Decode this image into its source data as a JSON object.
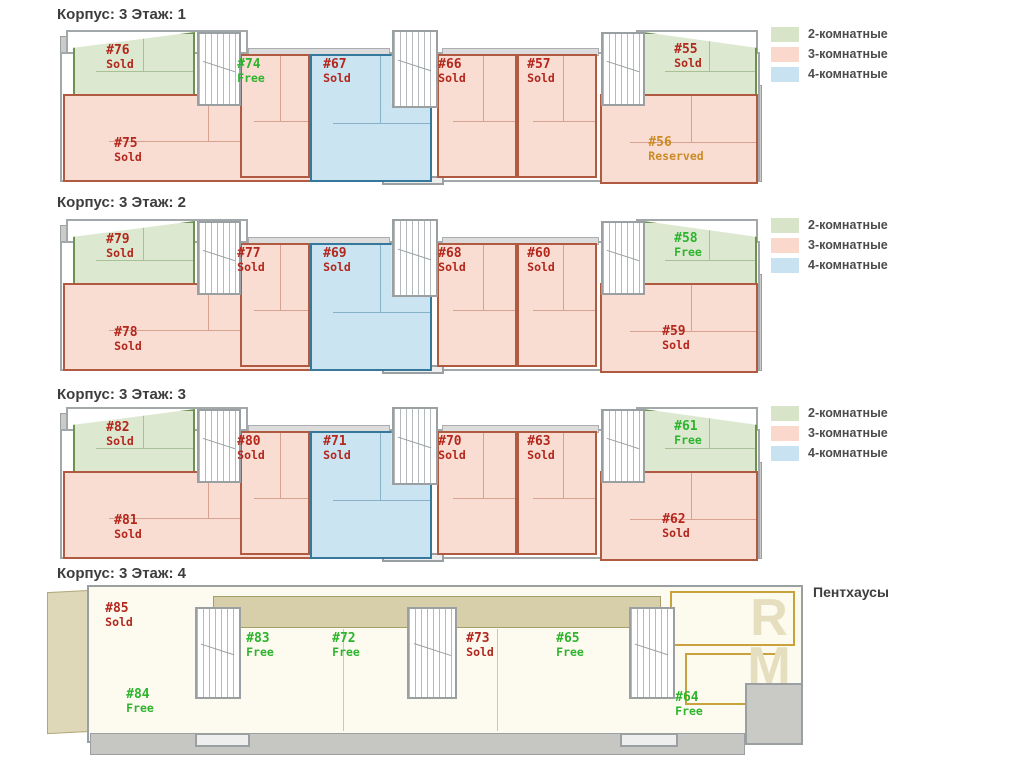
{
  "legend": {
    "items": [
      {
        "label": "2-комнатные",
        "color": "#d8e4c8"
      },
      {
        "label": "3-комнатные",
        "color": "#fad8cc"
      },
      {
        "label": "4-комнатные",
        "color": "#c8e2f2"
      }
    ]
  },
  "status_colors": {
    "Sold": "#b3271d",
    "Free": "#2db42d",
    "Reserved": "#ca8b26"
  },
  "floors": [
    {
      "title": "Корпус: 3 Этаж: 1",
      "units": [
        {
          "number": "#76",
          "status": "Sold",
          "type": "2k",
          "slot": "g-left"
        },
        {
          "number": "#75",
          "status": "Sold",
          "type": "3k",
          "slot": "p-bl"
        },
        {
          "number": "#74",
          "status": "Free",
          "type": "3k",
          "slot": "p-a"
        },
        {
          "number": "#67",
          "status": "Sold",
          "type": "4k",
          "slot": "blue"
        },
        {
          "number": "#66",
          "status": "Sold",
          "type": "3k",
          "slot": "p-b"
        },
        {
          "number": "#57",
          "status": "Sold",
          "type": "3k",
          "slot": "p-c"
        },
        {
          "number": "#55",
          "status": "Sold",
          "type": "2k",
          "slot": "g-right"
        },
        {
          "number": "#56",
          "status": "Reserved",
          "type": "3k",
          "slot": "p-br"
        }
      ]
    },
    {
      "title": "Корпус: 3 Этаж: 2",
      "units": [
        {
          "number": "#79",
          "status": "Sold",
          "type": "2k",
          "slot": "g-left"
        },
        {
          "number": "#78",
          "status": "Sold",
          "type": "3k",
          "slot": "p-bl"
        },
        {
          "number": "#77",
          "status": "Sold",
          "type": "3k",
          "slot": "p-a"
        },
        {
          "number": "#69",
          "status": "Sold",
          "type": "4k",
          "slot": "blue"
        },
        {
          "number": "#68",
          "status": "Sold",
          "type": "3k",
          "slot": "p-b"
        },
        {
          "number": "#60",
          "status": "Sold",
          "type": "3k",
          "slot": "p-c"
        },
        {
          "number": "#58",
          "status": "Free",
          "type": "2k",
          "slot": "g-right"
        },
        {
          "number": "#59",
          "status": "Sold",
          "type": "3k",
          "slot": "p-br"
        }
      ]
    },
    {
      "title": "Корпус: 3 Этаж: 3",
      "units": [
        {
          "number": "#82",
          "status": "Sold",
          "type": "2k",
          "slot": "g-left"
        },
        {
          "number": "#81",
          "status": "Sold",
          "type": "3k",
          "slot": "p-bl"
        },
        {
          "number": "#80",
          "status": "Sold",
          "type": "3k",
          "slot": "p-a"
        },
        {
          "number": "#71",
          "status": "Sold",
          "type": "4k",
          "slot": "blue"
        },
        {
          "number": "#70",
          "status": "Sold",
          "type": "3k",
          "slot": "p-b"
        },
        {
          "number": "#63",
          "status": "Sold",
          "type": "3k",
          "slot": "p-c"
        },
        {
          "number": "#61",
          "status": "Free",
          "type": "2k",
          "slot": "g-right"
        },
        {
          "number": "#62",
          "status": "Sold",
          "type": "3k",
          "slot": "p-br"
        }
      ]
    },
    {
      "title": "Корпус: 3 Этаж: 4",
      "annotation": "Пентхаусы",
      "watermark": [
        "R",
        "M"
      ],
      "units": [
        {
          "number": "#85",
          "status": "Sold",
          "type": "ph",
          "slot": "f85"
        },
        {
          "number": "#83",
          "status": "Free",
          "type": "ph",
          "slot": "f83"
        },
        {
          "number": "#72",
          "status": "Free",
          "type": "ph",
          "slot": "f72"
        },
        {
          "number": "#73",
          "status": "Sold",
          "type": "ph",
          "slot": "f73"
        },
        {
          "number": "#65",
          "status": "Free",
          "type": "ph",
          "slot": "f65"
        },
        {
          "number": "#84",
          "status": "Free",
          "type": "ph",
          "slot": "f84"
        },
        {
          "number": "#64",
          "status": "Free",
          "type": "ph",
          "slot": "f64"
        }
      ]
    }
  ]
}
